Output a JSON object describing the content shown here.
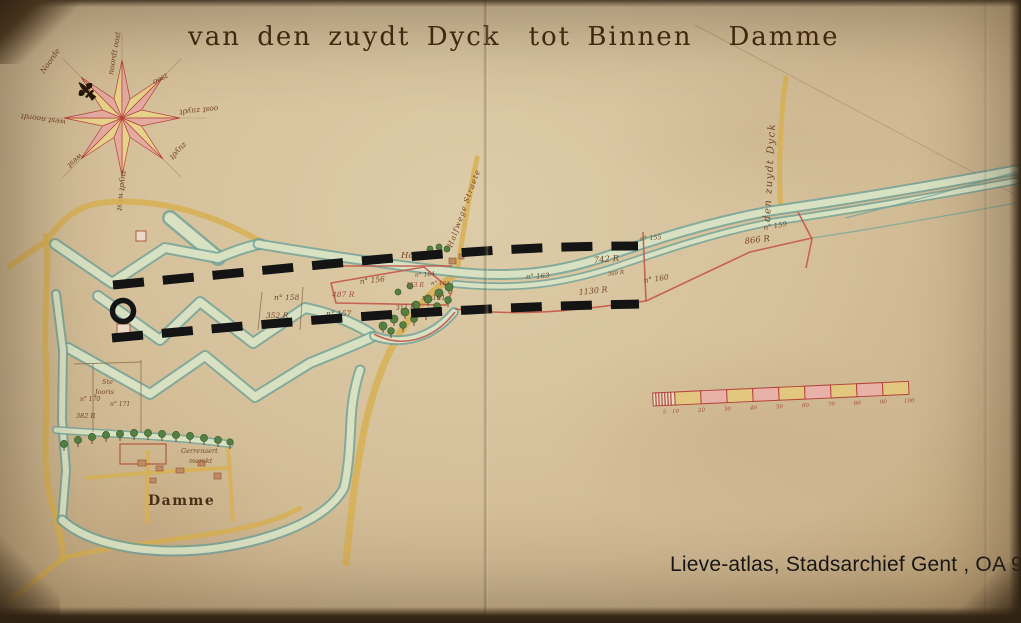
{
  "title_parts": [
    "van den zuydt Dyck",
    "tot Binnen",
    "Damme"
  ],
  "caption": "Lieve-atlas, Stadsarchief Gent , OA 98/11",
  "compass": {
    "labels": [
      "Noorde",
      "noordt oost",
      "oost",
      "oost zuydt",
      "zuydt",
      "zuydt west",
      "west",
      "west noordt"
    ]
  },
  "roads": {
    "zuydt_dyck": "den zuydt Dyck",
    "halfwege": "Halfwege Straete"
  },
  "places": {
    "damme": "Damme",
    "hooghe": "Hooghe",
    "ste_jooris_1": "Ste",
    "ste_jooris_2": "Jooris",
    "merckt_1": "Gerrenaert",
    "merckt_2": "merckt"
  },
  "parcels": {
    "n155": "n° 155",
    "n156": "n° 156",
    "n157": "n° 157",
    "n158": "n° 158",
    "n159": "n° 159",
    "n160": "n° 160",
    "n161": "n° 161",
    "n162": "n° 162",
    "n163": "n° 163",
    "n164": "n° 164",
    "n170": "n° 170",
    "n171": "n° 171",
    "a140": "140 R",
    "a153": "153 R",
    "a311": "311 R",
    "a352": "352 R",
    "a369": "369 R",
    "a382": "382 R",
    "a487": "487 R",
    "a742": "742 R",
    "a866": "866 R",
    "a1130": "1130 R"
  },
  "scalebar": {
    "ticks": [
      "5",
      "10",
      "20",
      "30",
      "40",
      "50",
      "60",
      "70",
      "80",
      "90",
      "100"
    ]
  },
  "colors": {
    "ink": "#44290f",
    "label_ink": "#754627",
    "red_ink": "#a14b3c",
    "road": "#d8b054",
    "band_edge": "#6fa29a",
    "band_fill": "#d8e2c2",
    "tree_green": "#567f41",
    "parcel_red": "#c4574d",
    "annotation_black": "#141414",
    "compass_yellow": "#e7d28b",
    "compass_pink": "#e3aba0",
    "scale_yellow": "#e2c87e",
    "scale_pink": "#e9b2a8",
    "scale_hatch_bg": "#e8dcc2",
    "scale_outline": "#b5443c",
    "caption_black": "#161616"
  }
}
